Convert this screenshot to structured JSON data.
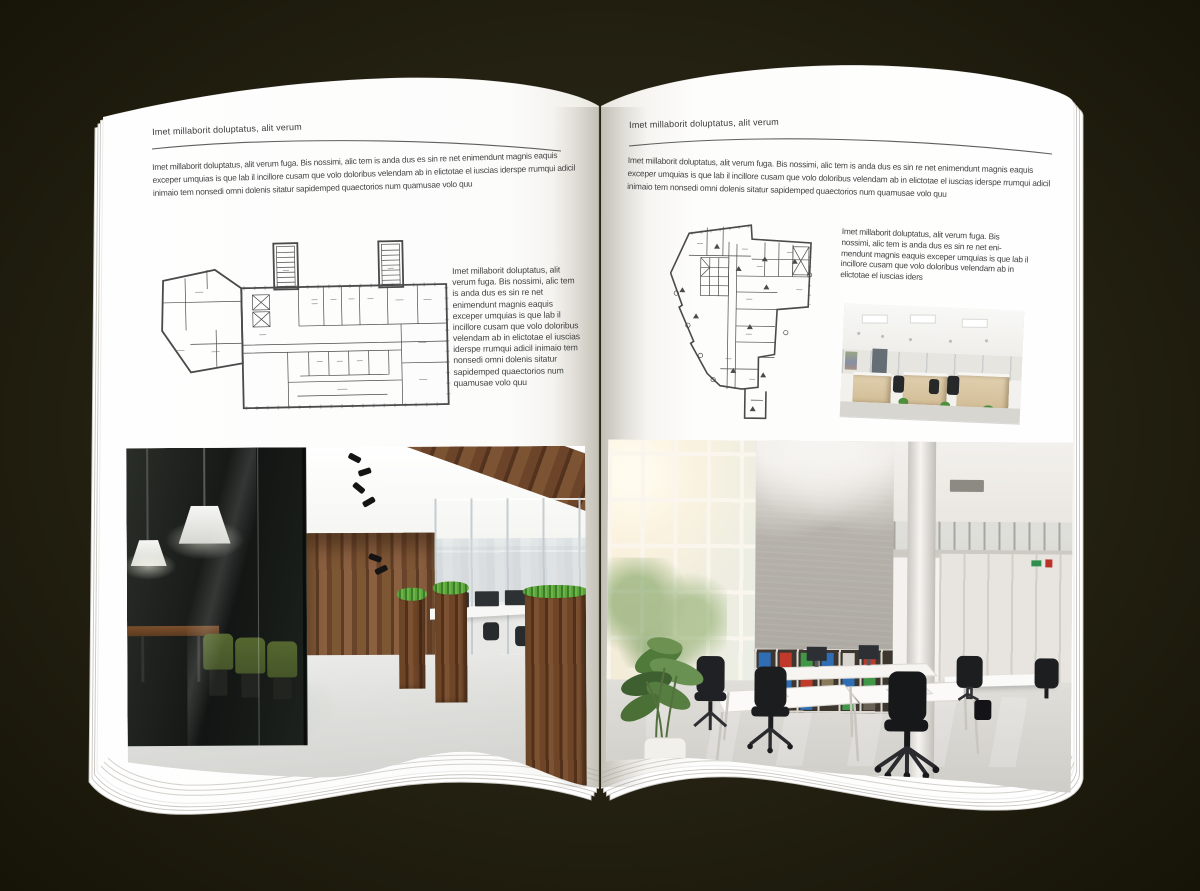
{
  "colors": {
    "backdrop": "#242112",
    "page": "#fdfdfc",
    "rule": "#5f5f5f",
    "body_text": "#424242"
  },
  "left_page": {
    "header": "Imet millaborit doluptatus, alit verum",
    "intro": "Imet millaborit doluptatus, alit verum fuga. Bis nossimi, alic tem is anda dus es sin re net enimendunt magnis eaquis exceper umquias is que lab il incillore cusam que volo doloribus velendam ab in elictotae el iuscias iderspe rrumqui adicil inimaio tem nonsedi omni dolenis sitatur sapidemped quaectorios num quamusae volo quu",
    "side_text": "Imet millaborit doluptatus, alit verum fuga. Bis nossimi, alic tem is anda dus es sin re net enimendunt magnis eaquis exceper umquias is que lab il incillore cusam que volo doloribus velendam ab in elictotae el iuscias iderspe rrumqui adicil inimaio tem nonsedi omni dolenis sitatur sapidemped quaectorios num quamusae volo quu"
  },
  "right_page": {
    "header": "Imet millaborit doluptatus, alit verum",
    "intro": "Imet millaborit doluptatus, alit verum fuga. Bis nossimi, alic tem is anda dus es sin re net enimendunt magnis eaquis exceper umquias is que lab il incillore cusam que volo doloribus velendam ab in elictotae el iuscias iderspe rrumqui adicil inimaio tem nonsedi omni dolenis sitatur sapidemped quaectorios num quamusae volo quu",
    "side_text": "Imet millaborit doluptatus, alit verum fuga. Bis nossimi, alic tem is anda dus es sin re net eni-mendunt magnis eaquis exceper umquias is que lab il incillore cusam que volo doloribus velendam ab in elictotae el iuscias iders"
  }
}
